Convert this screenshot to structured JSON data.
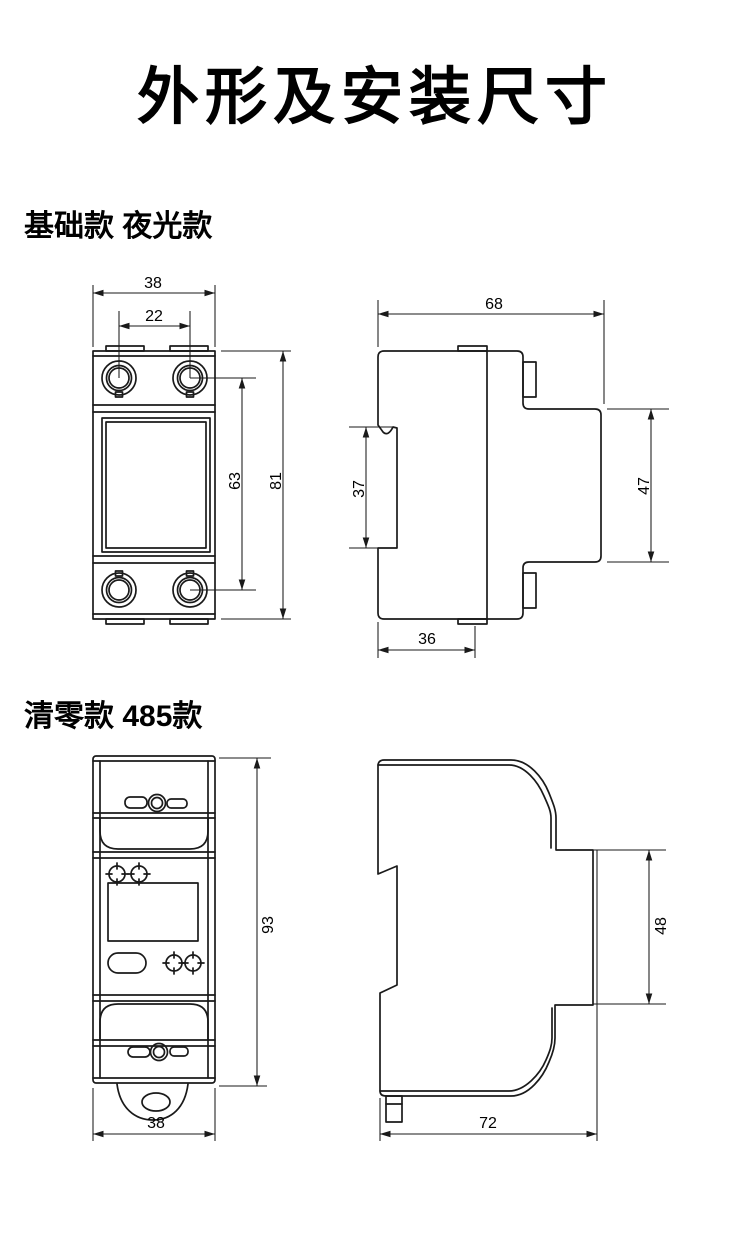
{
  "page": {
    "title": "外形及安装尺寸"
  },
  "colors": {
    "line": "#1a1a1a",
    "ink": "#000000",
    "background": "#ffffff"
  },
  "sections": [
    {
      "label": "基础款 夜光款",
      "front": {
        "overall_width_mm": "38",
        "terminal_pitch_mm": "22",
        "terminal_span_mm": "63",
        "overall_height_mm": "81"
      },
      "side": {
        "overall_depth_mm": "68",
        "rail_groove_mm": "37",
        "rail_section_mm": "47",
        "base_depth_mm": "36"
      }
    },
    {
      "label": "清零款 485款",
      "front": {
        "overall_height_mm": "93",
        "overall_width_mm": "38"
      },
      "side": {
        "rail_section_mm": "48",
        "overall_depth_mm": "72"
      }
    }
  ]
}
